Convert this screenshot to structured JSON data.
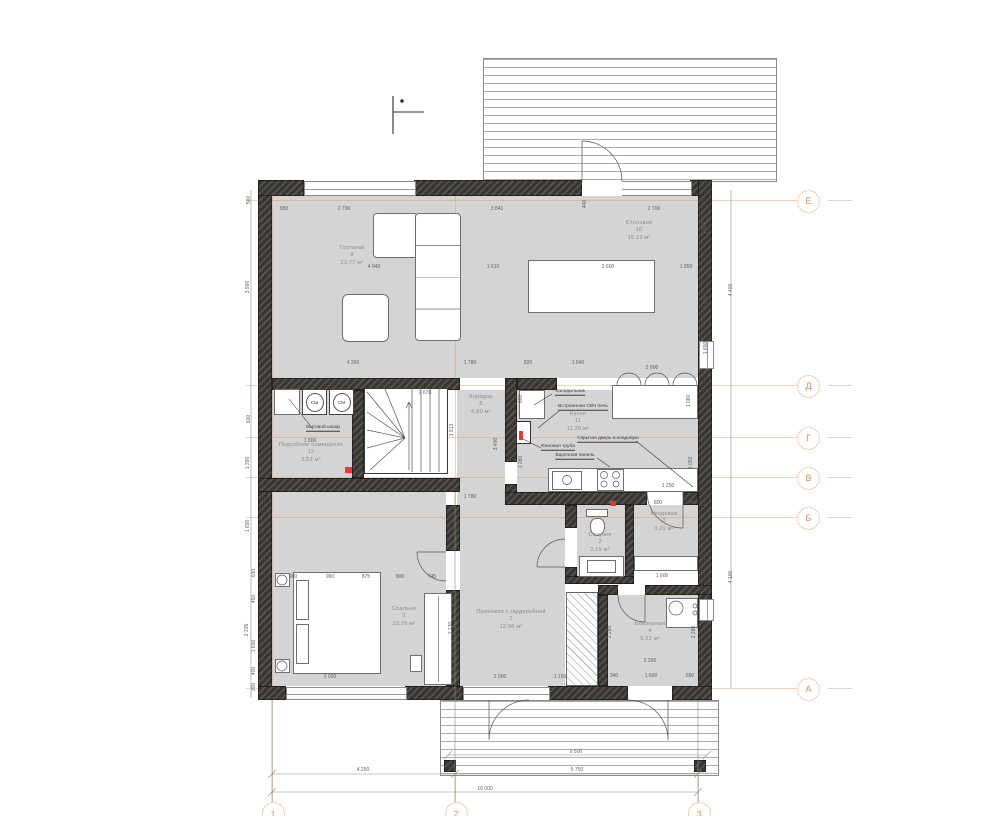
{
  "drawing": {
    "type": "floor-plan",
    "units": "mm"
  },
  "palette": {
    "wall": "#3a3631",
    "floor": "#d4d4d4",
    "axis_accent": "#dd8a52",
    "dim_text": "#5f5f5f",
    "marker_red": "#e03c31"
  },
  "axes": {
    "rows": [
      {
        "label": "Е",
        "y": 200
      },
      {
        "label": "Д",
        "y": 385
      },
      {
        "label": "Г",
        "y": 437
      },
      {
        "label": "В",
        "y": 477
      },
      {
        "label": "Б",
        "y": 517
      },
      {
        "label": "А",
        "y": 688
      }
    ],
    "cols": [
      {
        "label": "1",
        "x": 272
      },
      {
        "label": "2",
        "x": 455
      },
      {
        "label": "3",
        "x": 698
      }
    ]
  },
  "rooms": [
    {
      "name": "Гостиная",
      "number": "9",
      "area": "23,77 м²",
      "x": 352,
      "y": 256
    },
    {
      "name": "Столовая",
      "number": "10",
      "area": "19,13 м²",
      "x": 639,
      "y": 231
    },
    {
      "name": "Коридор",
      "number": "8",
      "area": "6,50 м²",
      "x": 481,
      "y": 405
    },
    {
      "name": "Кухня",
      "number": "11",
      "area": "11,20 м²",
      "x": 578,
      "y": 422
    },
    {
      "name": "Подсобное помещение",
      "number": "12",
      "area": "3,52 м²",
      "x": 311,
      "y": 453
    },
    {
      "name": "Санузел",
      "number": "2",
      "area": "2,15 м²",
      "x": 600,
      "y": 543
    },
    {
      "name": "Кладовая",
      "number": "3",
      "area": "3,20 м²",
      "x": 664,
      "y": 522
    },
    {
      "name": "Прихожая с гардеробной",
      "number": "1",
      "area": "12,96 м²",
      "x": 511,
      "y": 620
    },
    {
      "name": "Спальня",
      "number": "5",
      "area": "13,79 м²",
      "x": 404,
      "y": 617
    },
    {
      "name": "Бойлерная",
      "number": "4",
      "area": "5,22 м²",
      "x": 650,
      "y": 632
    }
  ],
  "annotations": [
    {
      "t": "Холодильник",
      "x": 570,
      "y": 392
    },
    {
      "t": "Встроенная СВЧ печь",
      "x": 583,
      "y": 407
    },
    {
      "t": "Скрытая дверь в кладовую",
      "x": 608,
      "y": 439
    },
    {
      "t": "Фановая труба",
      "x": 558,
      "y": 447
    },
    {
      "t": "Варочная панель",
      "x": 575,
      "y": 456
    },
    {
      "t": "Бытовой шкаф",
      "x": 323,
      "y": 428
    }
  ],
  "appliances": [
    {
      "label": "СШ",
      "x": 302,
      "y": 389
    },
    {
      "label": "СМ",
      "x": 329,
      "y": 389
    }
  ],
  "dimensions": [
    [
      "950",
      284,
      209,
      0
    ],
    [
      "2 700",
      344,
      209,
      0
    ],
    [
      "3 841",
      497,
      209,
      0
    ],
    [
      "440",
      585,
      204,
      1
    ],
    [
      "2 700",
      654,
      209,
      0
    ],
    [
      "4 040",
      374,
      267,
      0
    ],
    [
      "1 610",
      493,
      267,
      0
    ],
    [
      "3 600",
      608,
      267,
      0
    ],
    [
      "1 850",
      686,
      267,
      0
    ],
    [
      "4 360",
      353,
      363,
      0
    ],
    [
      "1 780",
      470,
      363,
      0
    ],
    [
      "820",
      528,
      363,
      0
    ],
    [
      "1 640",
      578,
      363,
      0
    ],
    [
      "2 000",
      652,
      368,
      0
    ],
    [
      "2 670",
      425,
      393,
      0
    ],
    [
      "1 800",
      310,
      441,
      0
    ],
    [
      "600",
      521,
      399,
      1
    ],
    [
      "1 080",
      689,
      401,
      1
    ],
    [
      "1 250",
      668,
      486,
      0
    ],
    [
      "1 050",
      691,
      463,
      1
    ],
    [
      "1 280",
      521,
      462,
      1
    ],
    [
      "3 400",
      496,
      444,
      1
    ],
    [
      "1 913",
      452,
      430,
      1
    ],
    [
      "1 780",
      470,
      497,
      0
    ],
    [
      "400",
      612,
      503,
      0
    ],
    [
      "800",
      658,
      503,
      0
    ],
    [
      "400",
      694,
      503,
      0
    ],
    [
      "1 600",
      662,
      576,
      0
    ],
    [
      "900",
      293,
      577,
      0
    ],
    [
      "900",
      330,
      577,
      0
    ],
    [
      "875",
      366,
      577,
      0
    ],
    [
      "800",
      400,
      577,
      0
    ],
    [
      "745",
      432,
      577,
      0
    ],
    [
      "2 130",
      451,
      628,
      1
    ],
    [
      "3 000",
      330,
      677,
      0
    ],
    [
      "2 000",
      500,
      677,
      0
    ],
    [
      "1 150",
      560,
      677,
      0
    ],
    [
      "2 290",
      650,
      661,
      0
    ],
    [
      "340",
      614,
      676,
      0
    ],
    [
      "1 600",
      651,
      676,
      0
    ],
    [
      "650",
      690,
      676,
      0
    ],
    [
      "2 280",
      610,
      632,
      1
    ],
    [
      "2 280",
      694,
      632,
      1
    ],
    [
      "500",
      249,
      200,
      1
    ],
    [
      "3 990",
      248,
      287,
      1
    ],
    [
      "600",
      249,
      419,
      1
    ],
    [
      "1 390",
      248,
      463,
      1
    ],
    [
      "1 650",
      248,
      526,
      1
    ],
    [
      "630",
      254,
      573,
      1
    ],
    [
      "450",
      254,
      599,
      1
    ],
    [
      "2 335",
      247,
      630,
      1
    ],
    [
      "1 600",
      254,
      646,
      1
    ],
    [
      "400",
      254,
      671,
      1
    ],
    [
      "300",
      254,
      687,
      1
    ],
    [
      "1 660",
      705,
      228,
      1
    ],
    [
      "1 220",
      706,
      302,
      1
    ],
    [
      "1 650",
      706,
      348,
      1
    ],
    [
      "4 400",
      731,
      290,
      1
    ],
    [
      "4 100",
      731,
      577,
      1
    ],
    [
      "6 500",
      576,
      752,
      0
    ],
    [
      "4 250",
      363,
      770,
      0
    ],
    [
      "5 750",
      577,
      770,
      0
    ],
    [
      "10 000",
      485,
      789,
      0
    ]
  ]
}
